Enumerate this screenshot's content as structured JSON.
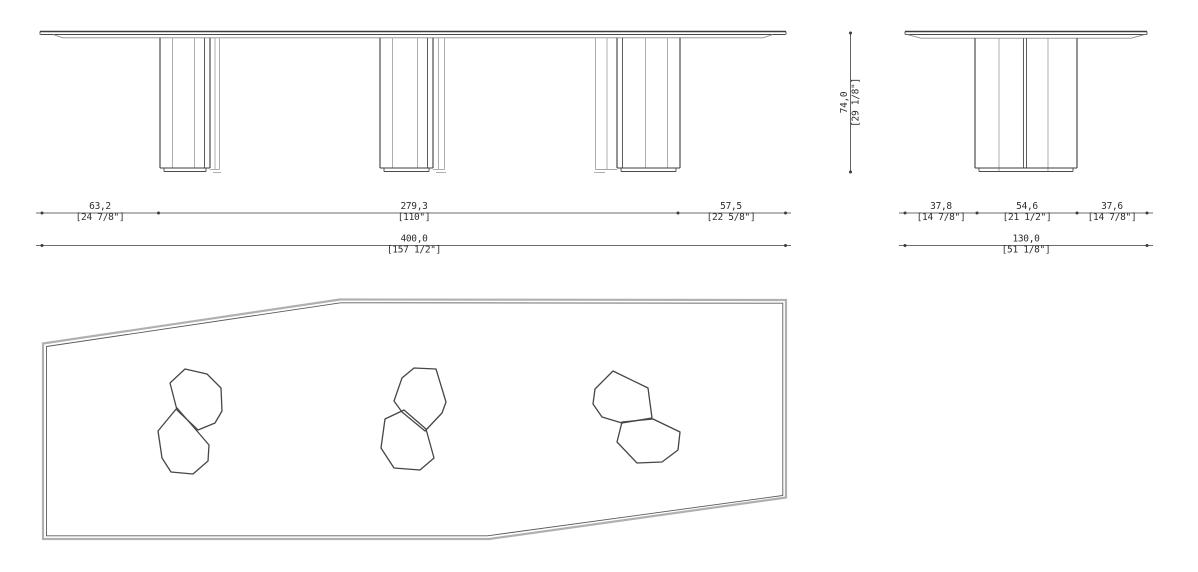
{
  "colors": {
    "background": "#ffffff",
    "line_dark": "#3c3c3c",
    "line_gray": "#a6a6a6",
    "outline_gray": "#b0b0b0",
    "text": "#2e2e2e"
  },
  "front_view": {
    "segment_dims": [
      {
        "mm": "63,2",
        "inches": "[24 7/8\"]"
      },
      {
        "mm": "279,3",
        "inches": "[110\"]"
      },
      {
        "mm": "57,5",
        "inches": "[22 5/8\"]"
      }
    ],
    "overall_dim": {
      "mm": "400,0",
      "inches": "[157 1/2\"]"
    },
    "height_dim": {
      "mm": "74,0",
      "inches": "[29 1/8\"]"
    }
  },
  "side_view": {
    "segment_dims": [
      {
        "mm": "37,8",
        "inches": "[14 7/8\"]"
      },
      {
        "mm": "54,6",
        "inches": "[21 1/2\"]"
      },
      {
        "mm": "37,6",
        "inches": "[14 7/8\"]"
      }
    ],
    "overall_dim": {
      "mm": "130,0",
      "inches": "[51 1/8\"]"
    }
  }
}
